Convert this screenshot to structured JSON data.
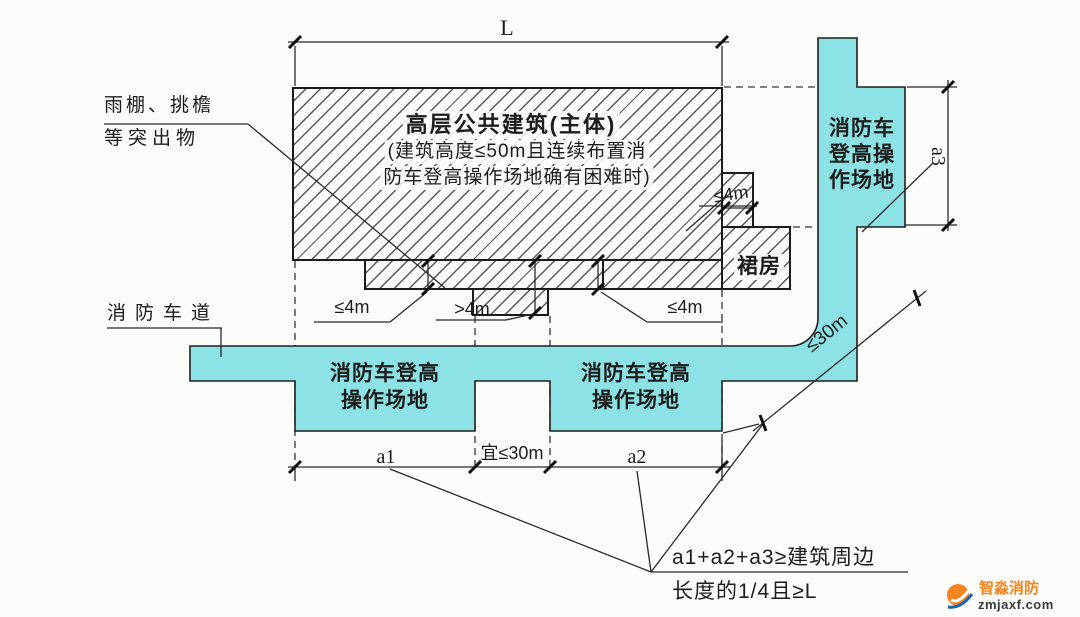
{
  "building": {
    "title": "高层公共建筑(主体)",
    "note_line1": "(建筑高度≤50m且连续布置消",
    "note_line2": "防车登高操作场地确有困难时)",
    "podium": "裙房"
  },
  "labels": {
    "protrusions_line1": "雨棚、挑檐",
    "protrusions_line2": "等突出物",
    "fire_lane": "消防车道"
  },
  "pads": {
    "west1_line1": "消防车登高",
    "west1_line2": "操作场地",
    "west2_line1": "消防车登高",
    "west2_line2": "操作场地",
    "east_line1": "消防车",
    "east_line2": "登高操",
    "east_line3": "作场地"
  },
  "dims": {
    "L": "L",
    "a1": "a1",
    "a2": "a2",
    "a3": "a3",
    "gap": "宜≤30m",
    "diagonal": "≤30m",
    "canopy_left": "≤4m",
    "notch": ">4m",
    "canopy_right": "≤4m",
    "step": "≤4m"
  },
  "formula": {
    "line1": "a1+a2+a3≥建筑周边",
    "line2": "长度的1/4且≥L"
  },
  "watermark": {
    "brand": "智淼消防",
    "site": "zmjaxf.com"
  },
  "colors": {
    "pad_fill": "#8DE2E5",
    "line": "#2A2A2A",
    "brand_orange": "#F5831F",
    "brand_blue": "#1565B0"
  }
}
